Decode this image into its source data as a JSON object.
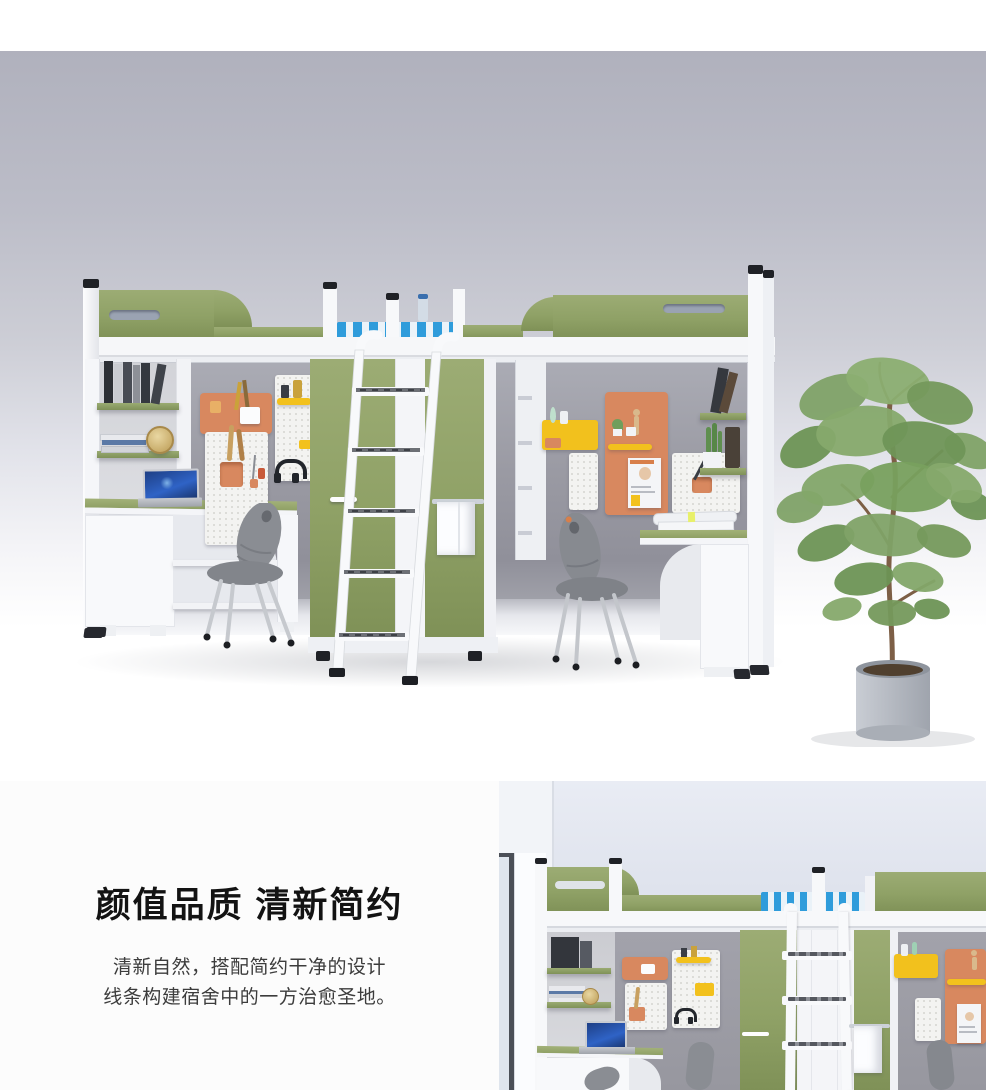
{
  "hero_photo": {
    "description": "3D render of a dormitory combo unit: two olive-green loft beds over study desks and bookshelves, pegboard organizers in orange, yellow and white, a shared green two-door wardrobe with a white hook-on ladder, blue striped mattress, a white towel on a rail, two grey chairs, a laptop on the left desk and a potted tree on the right.",
    "palette": {
      "wall": "#b2b3bf",
      "alcove_wall": "#9a9aa3",
      "floor": "#ffffff",
      "frame_white": "#f7f8fa",
      "panel_green": "#94a56c",
      "mattress_blue": "#2f9cdb",
      "pegboard_orange": "#d8885f",
      "pegboard_yellow": "#f2c11d",
      "pegboard_white": "#f3f3f1",
      "chair_grey": "#8a8d93",
      "towel_white": "#fcfdff",
      "plant_green": "#7fa062",
      "pot_grey": "#b4b9c0"
    }
  },
  "info_panel": {
    "heading": "颜值品质 清新简约",
    "body_lines": [
      "清新自然，搭配简约干净的设计",
      "线条构建宿舍中的一方治愈圣地。"
    ],
    "heading_color": "#131313",
    "body_color": "#3c3c3c"
  },
  "detail_photo": {
    "description": "Close-up render of the same loft-bed set: window at left, green headboards over a grey study alcove with shelves, laptop, pegboards, centre wardrobe with hook-on ladder and towel, grey chairs."
  }
}
